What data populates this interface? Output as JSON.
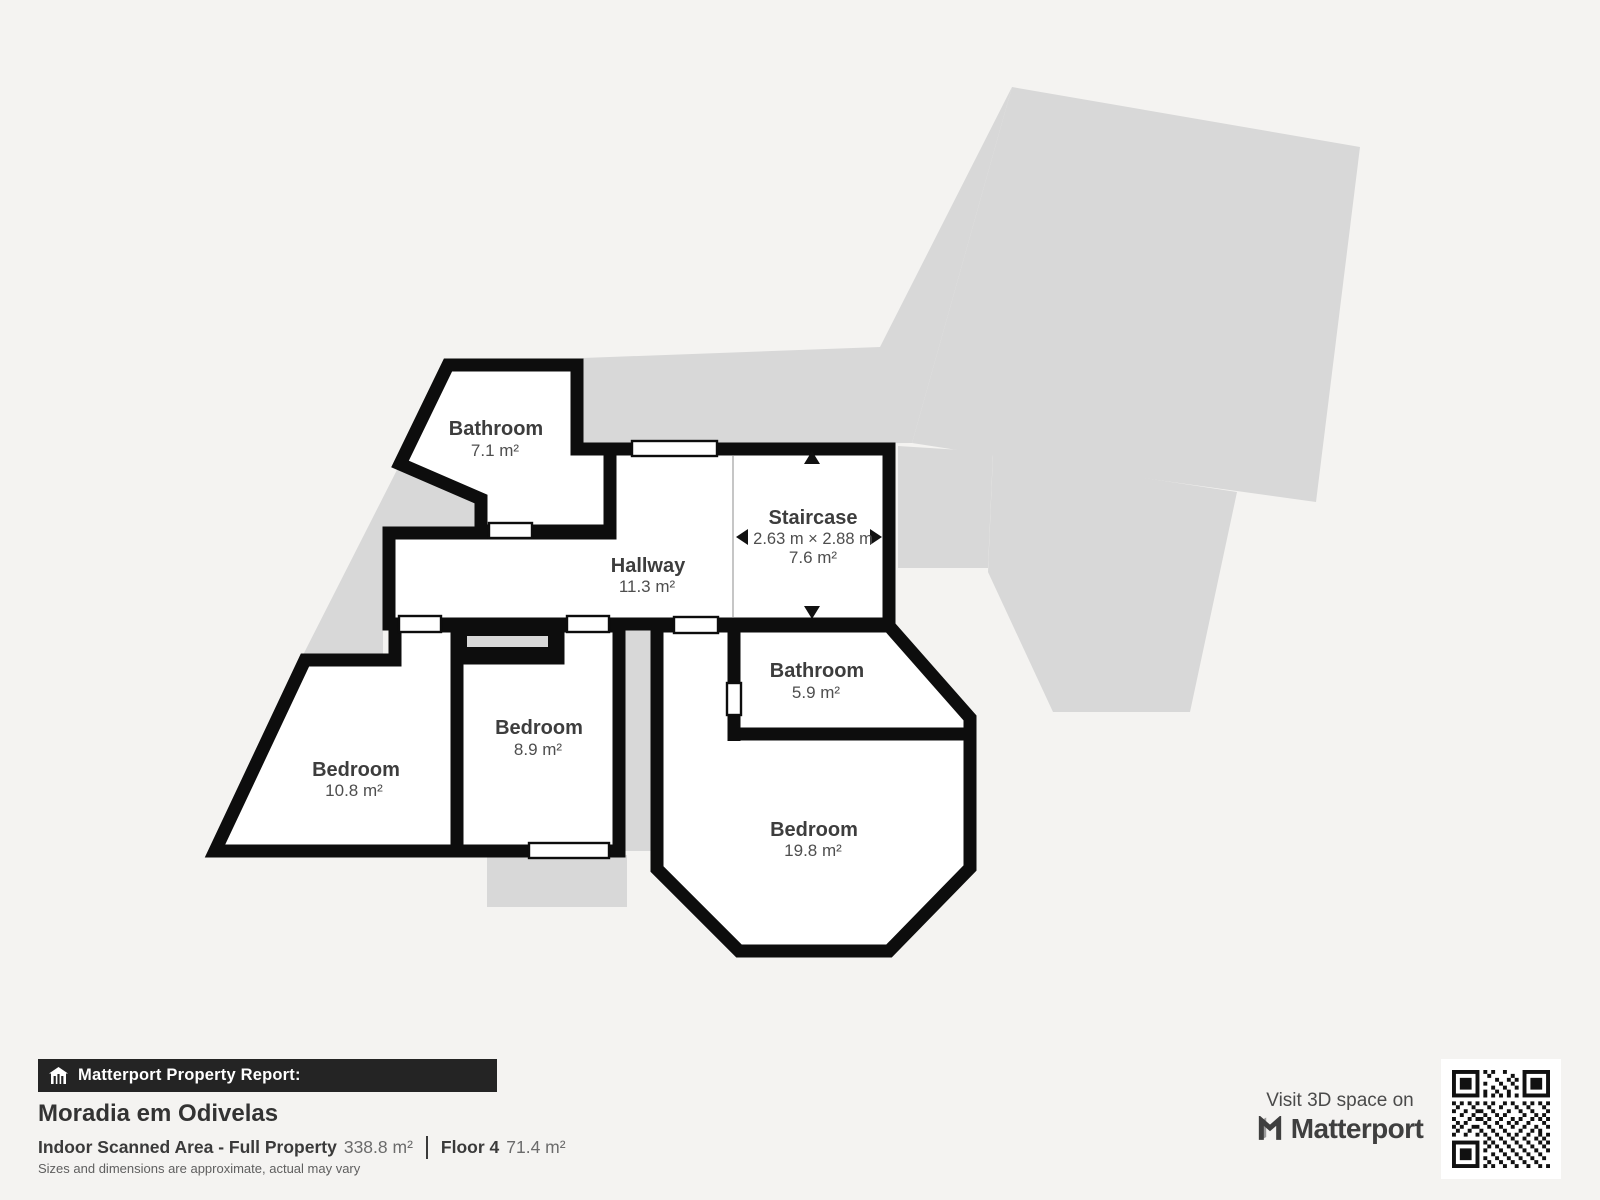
{
  "plan": {
    "rooms": [
      {
        "id": "bathroom-top",
        "name": "Bathroom",
        "area": "7.1 m²"
      },
      {
        "id": "hallway",
        "name": "Hallway",
        "area": "11.3 m²"
      },
      {
        "id": "staircase",
        "name": "Staircase",
        "dimensions": "2.63 m × 2.88 m",
        "area": "7.6 m²"
      },
      {
        "id": "bathroom-right",
        "name": "Bathroom",
        "area": "5.9 m²"
      },
      {
        "id": "bedroom-middle",
        "name": "Bedroom",
        "area": "8.9 m²"
      },
      {
        "id": "bedroom-left",
        "name": "Bedroom",
        "area": "10.8 m²"
      },
      {
        "id": "bedroom-bottom",
        "name": "Bedroom",
        "area": "19.8 m²"
      }
    ]
  },
  "footer": {
    "report_label": "Matterport Property Report:",
    "property_name": "Moradia em Odivelas",
    "area_label": "Indoor Scanned Area - Full Property",
    "area_value": "338.8 m²",
    "floor_label": "Floor 4",
    "floor_value": "71.4 m²",
    "disclaimer": "Sizes and dimensions are approximate, actual may vary"
  },
  "branding": {
    "visit_label": "Visit 3D space on",
    "brand_name": "Matterport"
  },
  "colors": {
    "background": "#f4f3f1",
    "wall": "#0d0d0d",
    "underlay": "#d8d8d8",
    "bar_background": "#242424",
    "label_text": "#3d3d3d"
  }
}
